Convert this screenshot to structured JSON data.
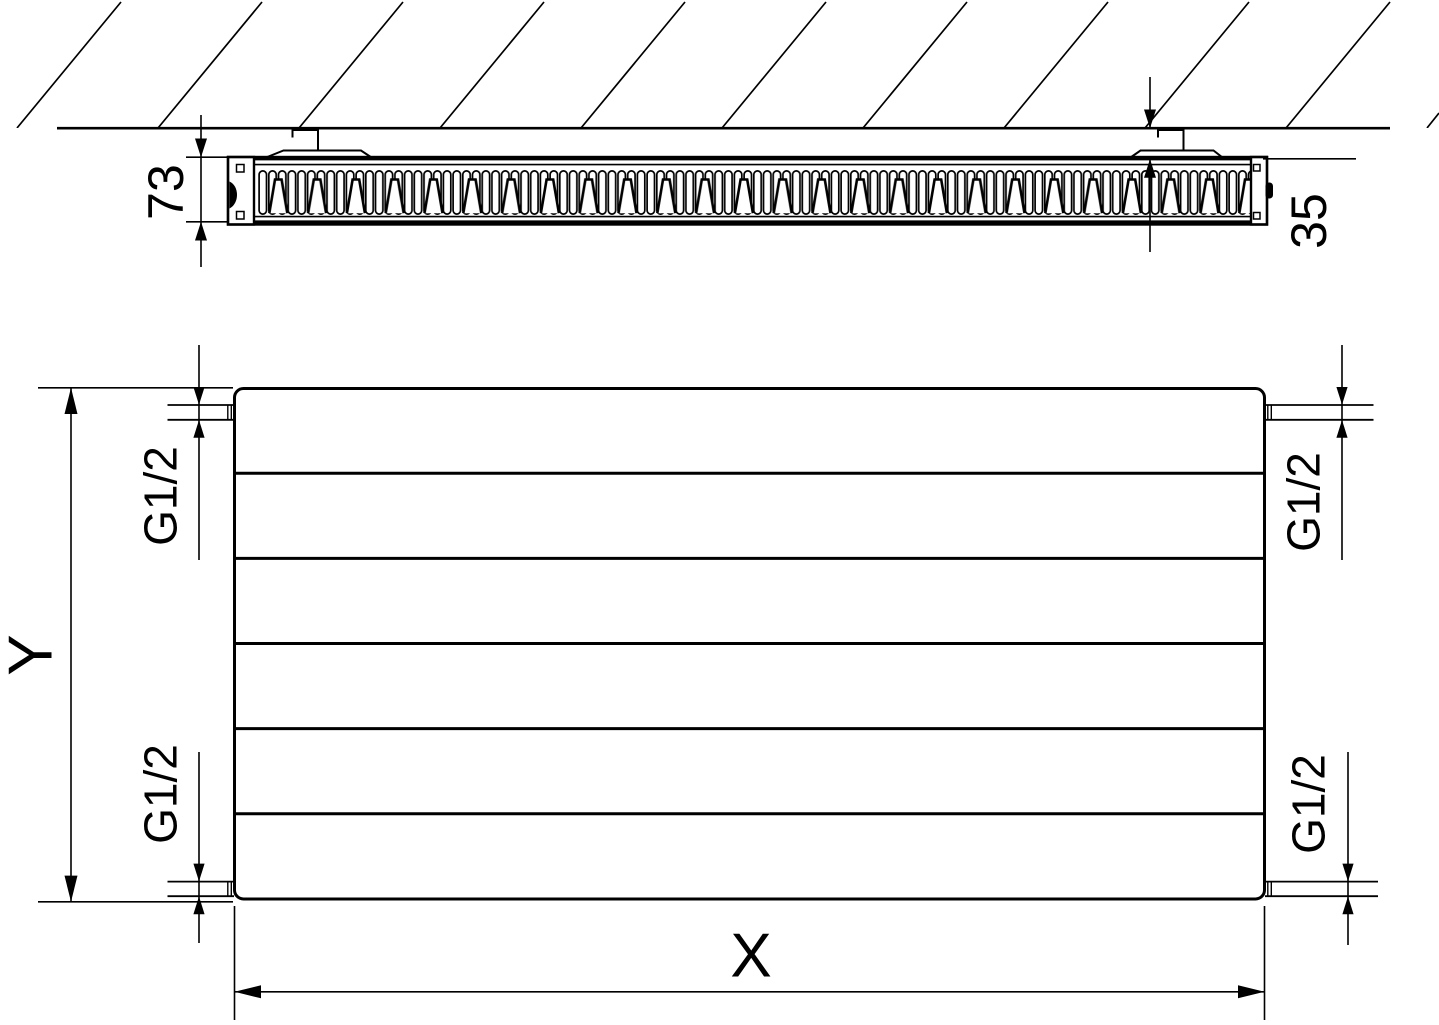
{
  "top_view": {
    "depth_label": "73",
    "wall_distance_label": "35"
  },
  "front_view": {
    "height_label": "Y",
    "width_label": "X",
    "thread_top_left": "G1/2",
    "thread_top_right": "G1/2",
    "thread_bottom_left": "G1/2",
    "thread_bottom_right": "G1/2"
  }
}
